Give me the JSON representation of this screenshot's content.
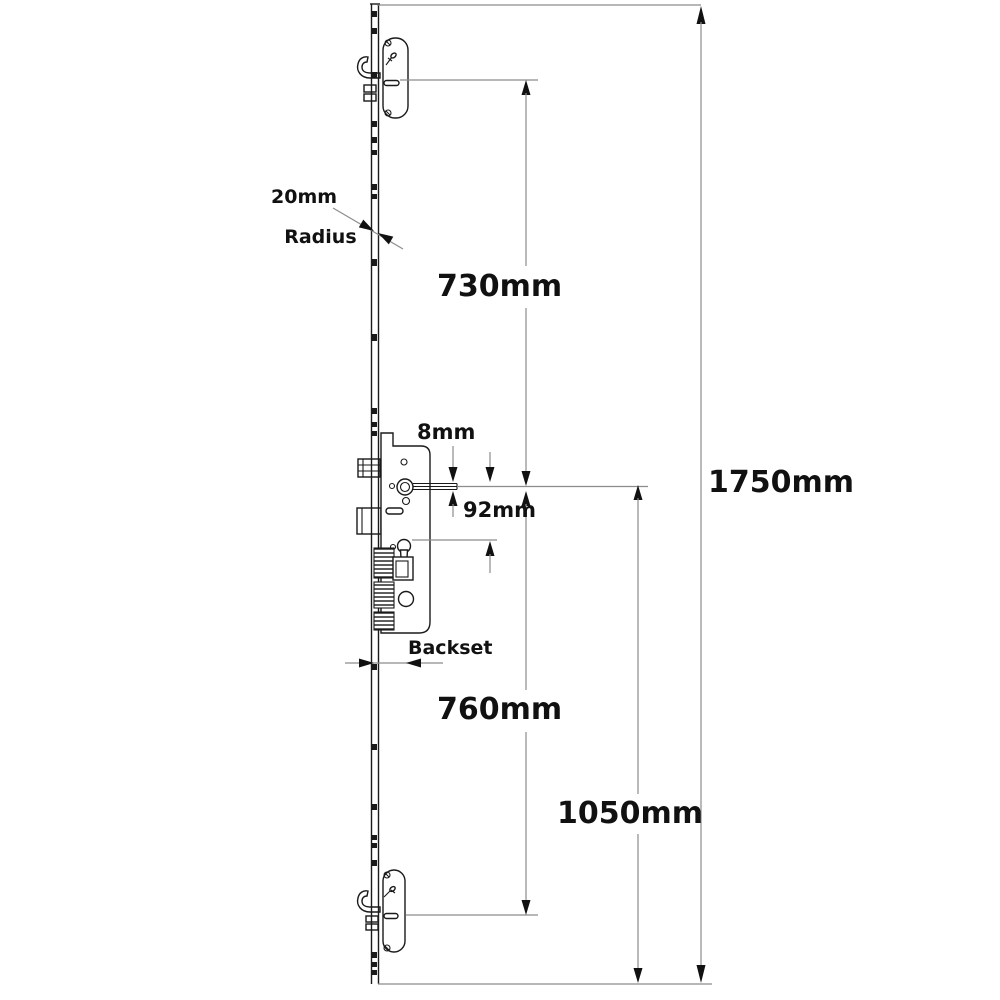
{
  "page": {
    "background": "#ffffff"
  },
  "drawing": {
    "ink": "#1a1a1a",
    "dim": "#8c8c8c",
    "arrow": "#111111",
    "text": "#111111",
    "bg": "#ffffff"
  },
  "labels": {
    "radius_line1": "20mm",
    "radius_line2": "Radius",
    "dim_top_hook_to_spindle": "730mm",
    "dim_overall_length": "1750mm",
    "dim_spindle_bar": "8mm",
    "dim_spindle_to_cylinder": "92mm",
    "backset": "Backset",
    "dim_spindle_to_bottom_hook": "760mm",
    "dim_spindle_to_bottom": "1050mm"
  }
}
